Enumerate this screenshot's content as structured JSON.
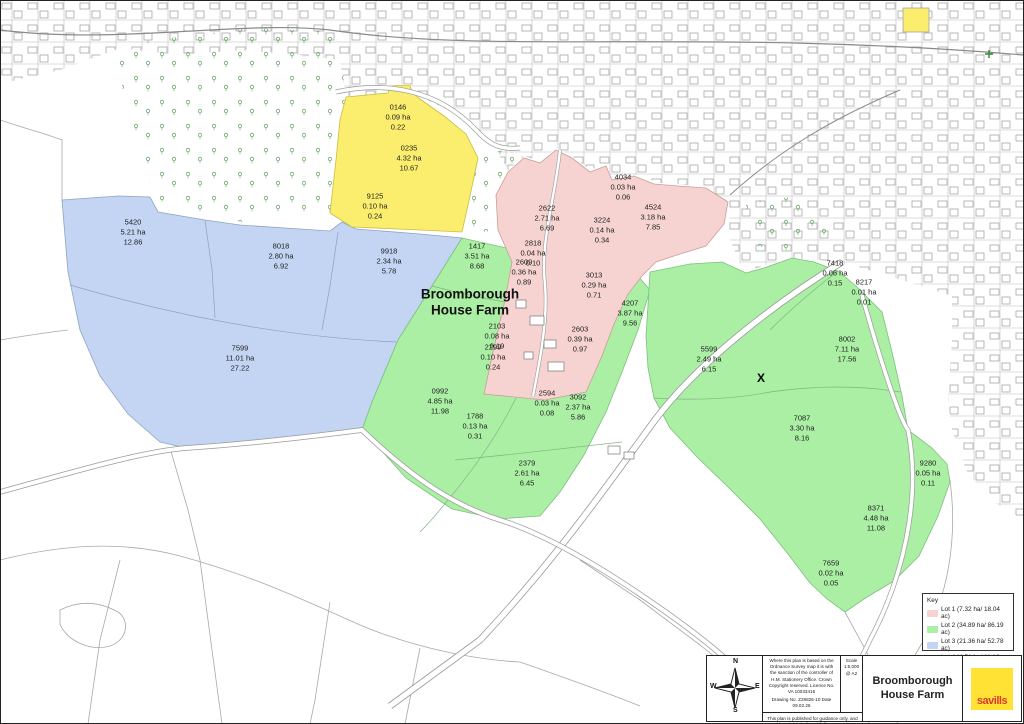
{
  "map": {
    "farm_label": "Broomborough\nHouse Farm",
    "x_mark": "X",
    "parcels": [
      {
        "lot": 3,
        "id": "5420",
        "ha": "5.21 ha",
        "ac": "12.86",
        "x": 133,
        "y": 232
      },
      {
        "lot": 3,
        "id": "8018",
        "ha": "2.80 ha",
        "ac": "6.92",
        "x": 281,
        "y": 256
      },
      {
        "lot": 3,
        "id": "9918",
        "ha": "2.34 ha",
        "ac": "5.78",
        "x": 389,
        "y": 261
      },
      {
        "lot": 3,
        "id": "7599",
        "ha": "11.01 ha",
        "ac": "27.22",
        "x": 240,
        "y": 358
      },
      {
        "lot": 4,
        "id": "0146",
        "ha": "0.09 ha",
        "ac": "0.22",
        "x": 398,
        "y": 117
      },
      {
        "lot": 4,
        "id": "0235",
        "ha": "4.32 ha",
        "ac": "10.67",
        "x": 409,
        "y": 158
      },
      {
        "lot": 4,
        "id": "9125",
        "ha": "0.10 ha",
        "ac": "0.24",
        "x": 375,
        "y": 206
      },
      {
        "lot": 1,
        "id": "2622",
        "ha": "2.71 ha",
        "ac": "6.69",
        "x": 547,
        "y": 218
      },
      {
        "lot": 1,
        "id": "4034",
        "ha": "0.03 ha",
        "ac": "0.06",
        "x": 623,
        "y": 187
      },
      {
        "lot": 1,
        "id": "3224",
        "ha": "0.14 ha",
        "ac": "0.34",
        "x": 602,
        "y": 230
      },
      {
        "lot": 1,
        "id": "4524",
        "ha": "3.18 ha",
        "ac": "7.85",
        "x": 653,
        "y": 217
      },
      {
        "lot": 1,
        "id": "2818",
        "ha": "0.04 ha",
        "ac": "0.10",
        "x": 533,
        "y": 253
      },
      {
        "lot": 1,
        "id": "2609",
        "ha": "0.36 ha",
        "ac": "0.89",
        "x": 524,
        "y": 272
      },
      {
        "lot": 1,
        "id": "3013",
        "ha": "0.29 ha",
        "ac": "0.71",
        "x": 594,
        "y": 285
      },
      {
        "lot": 1,
        "id": "2103",
        "ha": "0.08 ha",
        "ac": "0.19",
        "x": 497,
        "y": 336
      },
      {
        "lot": 1,
        "id": "2299",
        "ha": "0.10 ha",
        "ac": "0.24",
        "x": 493,
        "y": 357
      },
      {
        "lot": 1,
        "id": "2603",
        "ha": "0.39 ha",
        "ac": "0.97",
        "x": 580,
        "y": 339
      },
      {
        "lot": 2,
        "id": "1417",
        "ha": "3.51 ha",
        "ac": "8.68",
        "x": 477,
        "y": 256
      },
      {
        "lot": 2,
        "id": "4207",
        "ha": "3.87 ha",
        "ac": "9.56",
        "x": 630,
        "y": 313
      },
      {
        "lot": 2,
        "id": "5599",
        "ha": "2.49 ha",
        "ac": "6.15",
        "x": 709,
        "y": 359
      },
      {
        "lot": 2,
        "id": "7418",
        "ha": "0.06 ha",
        "ac": "0.15",
        "x": 835,
        "y": 273
      },
      {
        "lot": 2,
        "id": "8217",
        "ha": "0.01 ha",
        "ac": "0.01",
        "x": 864,
        "y": 292
      },
      {
        "lot": 2,
        "id": "8002",
        "ha": "7.11 ha",
        "ac": "17.56",
        "x": 847,
        "y": 349
      },
      {
        "lot": 2,
        "id": "0992",
        "ha": "4.85 ha",
        "ac": "11.98",
        "x": 440,
        "y": 401
      },
      {
        "lot": 2,
        "id": "1788",
        "ha": "0.13 ha",
        "ac": "0.31",
        "x": 475,
        "y": 426
      },
      {
        "lot": 2,
        "id": "2594",
        "ha": "0.03 ha",
        "ac": "0.08",
        "x": 547,
        "y": 403
      },
      {
        "lot": 2,
        "id": "3092",
        "ha": "2.37 ha",
        "ac": "5.86",
        "x": 578,
        "y": 407
      },
      {
        "lot": 2,
        "id": "2379",
        "ha": "2.61 ha",
        "ac": "6.45",
        "x": 527,
        "y": 473
      },
      {
        "lot": 2,
        "id": "7087",
        "ha": "3.30 ha",
        "ac": "8.16",
        "x": 802,
        "y": 428
      },
      {
        "lot": 2,
        "id": "9280",
        "ha": "0.05 ha",
        "ac": "0.11",
        "x": 928,
        "y": 473
      },
      {
        "lot": 2,
        "id": "8371",
        "ha": "4.48 ha",
        "ac": "11.08",
        "x": 876,
        "y": 518
      },
      {
        "lot": 2,
        "id": "7659",
        "ha": "0.02 ha",
        "ac": "0.05",
        "x": 831,
        "y": 573
      }
    ]
  },
  "key": {
    "heading": "Key",
    "items": [
      {
        "label": "Lot 1 (7.32 ha/ 18.04 ac)",
        "color": "#f6d3d0"
      },
      {
        "label": "Lot 2 (34.89 ha/ 86.19 ac)",
        "color": "#aaefa4"
      },
      {
        "label": "Lot 3 (21.36 ha/ 52.78 ac)",
        "color": "#c3d5f3"
      },
      {
        "label": "Lot 4 (4.51 ha/ 11.13 ac)",
        "color": "#fbee6e"
      }
    ]
  },
  "compass": {
    "n": "N",
    "e": "E",
    "s": "S",
    "w": "W"
  },
  "title_block": {
    "os_disclaimer": "Where this plan is based on the Ordnance Survey map it is with the sanction of the controller of H.M. Stationery Office. Crown Copyright reserved. Licence No. VA 10033416",
    "drawing_line": "Drawing No. Z28826-10    Date 09.02.26",
    "scale": "Scale\n1:5,000\n@ A2",
    "guidance": "This plan is published for guidance only, and although it is believed to be correct its accuracy is not guaranteed, nor is it intended to form part of any contract",
    "title": "Broomborough\nHouse Farm",
    "logo_text": "savills"
  },
  "colors": {
    "lot1_pink": "#f6d3d0",
    "lot2_green": "#aaefa4",
    "lot3_blue": "#c3d5f3",
    "lot4_yellow": "#fbee6e",
    "savills_yellow": "#ffe233",
    "savills_red": "#d93a35"
  }
}
